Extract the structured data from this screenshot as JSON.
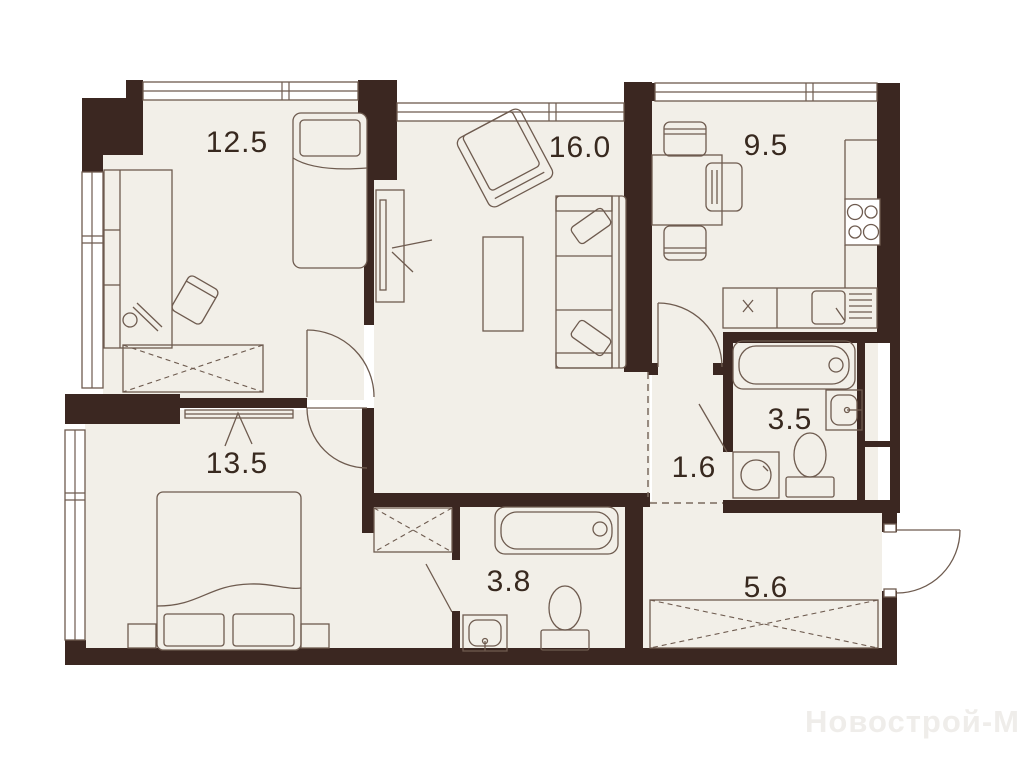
{
  "watermark": "Новострой-М",
  "room_labels": [
    "12.5",
    "16.0",
    "9.5",
    "13.5",
    "1.6",
    "3.5",
    "3.8",
    "5.6"
  ],
  "colors": {
    "background": "#ffffff",
    "floor": "#f2efe8",
    "wall": "#3b2721",
    "furniture_line": "#6e5b4f",
    "label_text": "#38291f",
    "watermark_text": "#efedea"
  }
}
